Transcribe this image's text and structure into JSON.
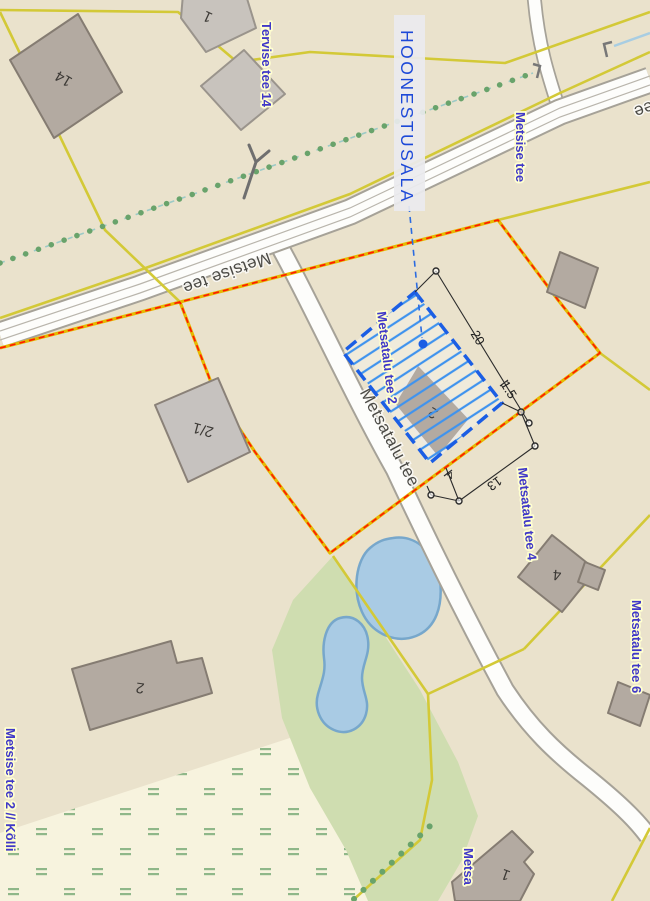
{
  "map": {
    "area_label": "HOONESTUSALA",
    "road_labels": {
      "main": "Metsise tee",
      "main_partial": "Metsise tee",
      "south": "Metsatalu tee"
    },
    "address_labels": {
      "tervise14": "Tervise tee 14",
      "metsise": "Metsise tee",
      "metsatalu2": "Metsatalu tee 2",
      "metsatalu4": "Metsatalu tee 4",
      "metsatalu6": "Metsatalu tee 6",
      "metsise2": "Metsise tee 2 // Kõlli",
      "metsa_partial": "Metsa"
    },
    "building_labels": {
      "b14": "14",
      "b1top": "1",
      "b21": "2/1",
      "b2hoone": "2",
      "b4": "4",
      "b2big": "2",
      "b1br": "1"
    },
    "dimensions": {
      "d20": "20",
      "d1_5": "1.5",
      "d13": "13",
      "d4": "4"
    },
    "colors": {
      "base": "#eae2cc",
      "light_meadow": "#f7f3de",
      "green_area": "#cfddb0",
      "water": "#a9cbe4",
      "water_edge": "#77a7cb",
      "parcel_line": "#d3c937",
      "boundary_yellow": "#e5b900",
      "boundary_red": "#ff1a00",
      "road_fill": "#fdfdfb",
      "road_casing": "#a6a298",
      "hoonestusala_blue": "#1b5ee4",
      "hatch_blue": "#3f93ee",
      "address_blue": "#4038c8",
      "building_fill": "#b3aaa1",
      "building_stroke": "#857c72",
      "tree_dot_green": "#69a36b"
    }
  }
}
